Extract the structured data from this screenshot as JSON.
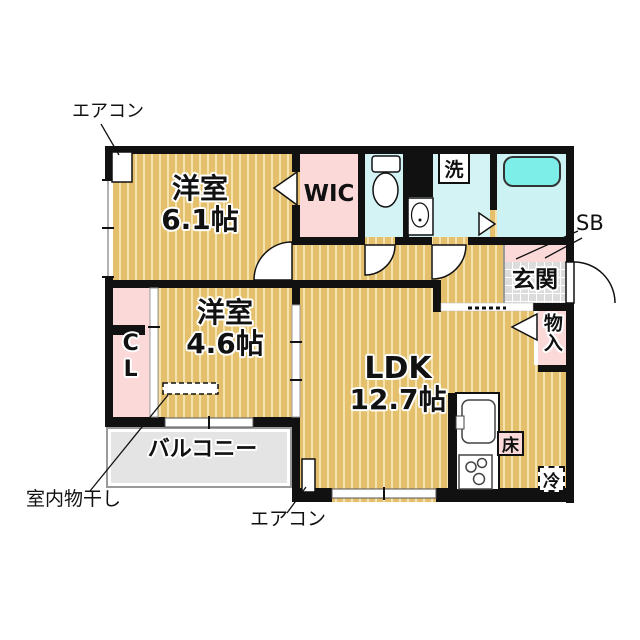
{
  "colors": {
    "wall": "#111111",
    "wood_floor": "#e5c06c",
    "wood_stripe": "#f4e3ae",
    "pink_room": "#fbd9d9",
    "wet_area": "#d4f3f4",
    "bathtub": "#7deee8",
    "entrance_tile": "#dcdcdc",
    "balcony": "#e4e4e4"
  },
  "rooms": {
    "bedroom1": {
      "name": "洋室",
      "size": "6.1帖"
    },
    "bedroom2": {
      "name": "洋室",
      "size": "4.6帖"
    },
    "ldk": {
      "name": "LDK",
      "size": "12.7帖"
    },
    "wic": "WIC",
    "closet": "CL",
    "entrance": "玄関",
    "storage": "物入",
    "shoe_box": "SB",
    "balcony": "バルコニー",
    "washer": "洗",
    "floor_storage": "床",
    "refrigerator": "冷"
  },
  "annotations": {
    "aircon_top": "エアコン",
    "aircon_bottom": "エアコン",
    "indoor_drying": "室内物干し"
  }
}
